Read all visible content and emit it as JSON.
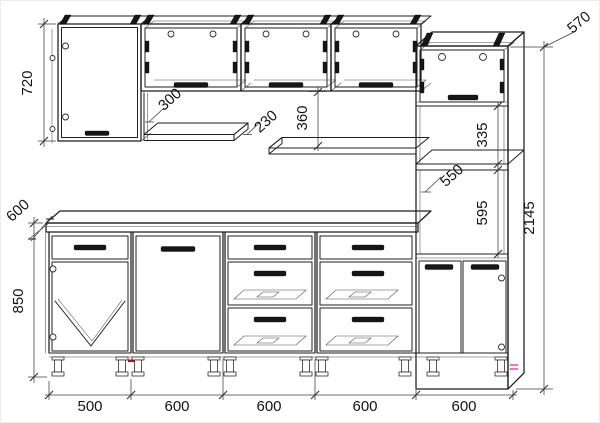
{
  "drawing": {
    "kind": "kitchen-furniture-elevation",
    "units": "mm",
    "colors": {
      "line": "#1f1f1f",
      "dimension": "#3c3c3c",
      "accent_red": "#9c2222",
      "accent_pink": "#e8469c",
      "background": "#ffffff"
    },
    "dims": {
      "wall_cabinet_height": "720",
      "wall_cabinet_depth": "300",
      "shelf_depth": "230",
      "apron_height": "360",
      "tall_cabinet_depth": "570",
      "upper_niche_height": "335",
      "niche_inner_width": "550",
      "oven_niche_height": "595",
      "total_height": "2145",
      "worktop_depth": "600",
      "base_height": "850",
      "unit_widths": [
        "500",
        "600",
        "600",
        "600",
        "600"
      ]
    }
  }
}
